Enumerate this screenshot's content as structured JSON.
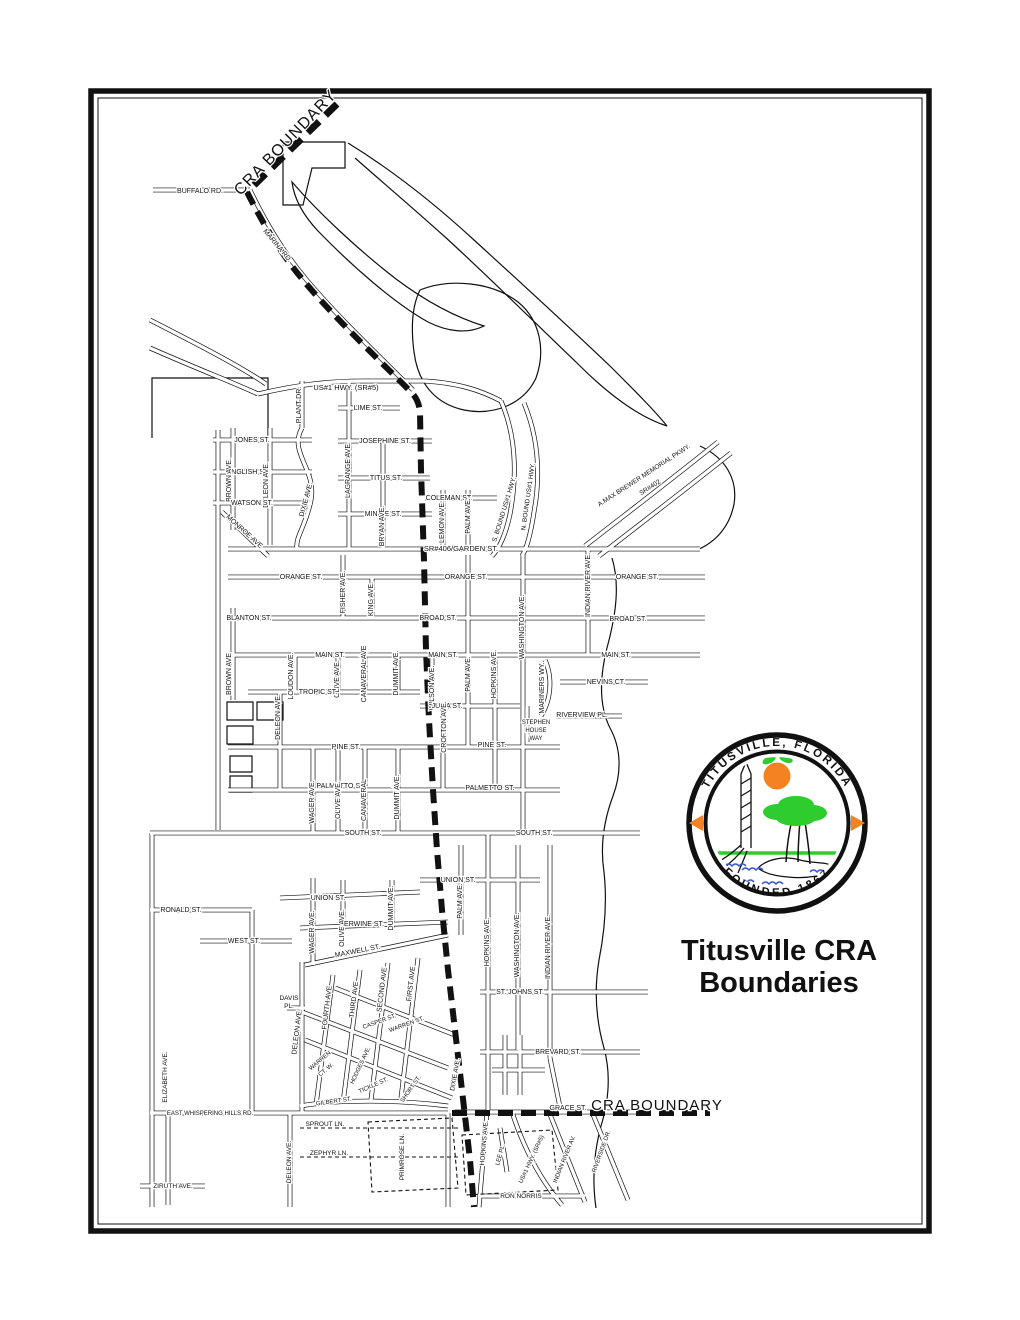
{
  "title": {
    "line1": "Titusville CRA",
    "line2": "Boundaries"
  },
  "seal": {
    "top_text": "TITUSVILLE, FLORIDA",
    "bottom_text": "FOUNDED  1867"
  },
  "colors": {
    "ink": "#111111",
    "seal_orange": "#F58220",
    "seal_green": "#2FCC2F",
    "seal_blue": "#3B5BCF"
  },
  "boundary": {
    "label_top": "CRA BOUNDARY",
    "label_bottom": "CRA BOUNDARY"
  },
  "map": {
    "labels": [
      {
        "t": "CRA BOUNDARY",
        "x": 289,
        "y": 146,
        "r": -46,
        "s": 16,
        "ls": 1
      },
      {
        "t": "BUFFALO RD.",
        "x": 200,
        "y": 193
      },
      {
        "t": "MARINA RD.",
        "x": 276,
        "y": 247,
        "r": 50
      },
      {
        "t": "US#1 HWY. (SR#5)",
        "x": 346,
        "y": 390,
        "s": 7.5
      },
      {
        "t": "PLANT DR.",
        "x": 301,
        "y": 405,
        "r": -90
      },
      {
        "t": "LIME ST.",
        "x": 368,
        "y": 410
      },
      {
        "t": "JONES ST.",
        "x": 252,
        "y": 442
      },
      {
        "t": "JOSEPHINE ST.",
        "x": 385,
        "y": 443
      },
      {
        "t": "ENGLISH ST.",
        "x": 248,
        "y": 474
      },
      {
        "t": "TITUS ST.",
        "x": 386,
        "y": 480
      },
      {
        "t": "BROWN AVE.",
        "x": 231,
        "y": 480,
        "r": -90
      },
      {
        "t": "DELEON AVE.",
        "x": 268,
        "y": 485,
        "r": -90
      },
      {
        "t": "DIXIE AVE.",
        "x": 308,
        "y": 500,
        "r": -75
      },
      {
        "t": "LAGRANGE AVE.",
        "x": 350,
        "y": 470,
        "r": -90
      },
      {
        "t": "WATSON ST.",
        "x": 252,
        "y": 505
      },
      {
        "t": "COLEMAN ST.",
        "x": 449,
        "y": 500
      },
      {
        "t": "MINNIE ST.",
        "x": 383,
        "y": 516
      },
      {
        "t": "BRYAN AVE.",
        "x": 384,
        "y": 526,
        "r": -90
      },
      {
        "t": "MONROE AVE",
        "x": 243,
        "y": 533,
        "r": 42
      },
      {
        "t": "LEMON AVE.",
        "x": 444,
        "y": 522,
        "r": -90
      },
      {
        "t": "PALM AVE.",
        "x": 470,
        "y": 516,
        "r": -90
      },
      {
        "t": "S. BOUND US#1 HWY.",
        "x": 506,
        "y": 510,
        "r": -73,
        "s": 6.5
      },
      {
        "t": "N. BOUND US#1 HWY.",
        "x": 530,
        "y": 497,
        "r": -82,
        "s": 6.5
      },
      {
        "t": "A.MAX BREWER MEMORIAL PKWY.",
        "x": 645,
        "y": 477,
        "r": -33,
        "s": 6.5
      },
      {
        "t": "SR#402",
        "x": 651,
        "y": 489,
        "r": -33,
        "s": 6.5
      },
      {
        "t": "SR#406/GARDEN ST.",
        "x": 461,
        "y": 551,
        "s": 7.5
      },
      {
        "t": "ORANGE ST.",
        "x": 301,
        "y": 579
      },
      {
        "t": "ORANGE ST.",
        "x": 466,
        "y": 579
      },
      {
        "t": "ORANGE ST.",
        "x": 637,
        "y": 579
      },
      {
        "t": "FISHER AVE.",
        "x": 345,
        "y": 592,
        "r": -90
      },
      {
        "t": "KING AVE.",
        "x": 373,
        "y": 599,
        "r": -90
      },
      {
        "t": "INDIAN RIVER AVE.",
        "x": 590,
        "y": 585,
        "r": -90
      },
      {
        "t": "BLANTON ST.",
        "x": 249,
        "y": 620
      },
      {
        "t": "BROAD ST.",
        "x": 438,
        "y": 620
      },
      {
        "t": "BROAD ST.",
        "x": 628,
        "y": 621
      },
      {
        "t": "WASHINGTON AVE.",
        "x": 524,
        "y": 627,
        "r": -90
      },
      {
        "t": "MAIN ST.",
        "x": 330,
        "y": 657
      },
      {
        "t": "MAIN ST.",
        "x": 443,
        "y": 657
      },
      {
        "t": "MAIN ST.",
        "x": 616,
        "y": 657
      },
      {
        "t": "BROWN AVE",
        "x": 231,
        "y": 674,
        "r": -90
      },
      {
        "t": "LOUDON AVE.",
        "x": 293,
        "y": 676,
        "r": -90
      },
      {
        "t": "OLIVE AVE.",
        "x": 339,
        "y": 679,
        "r": -90
      },
      {
        "t": "CANAVERAL AVE",
        "x": 366,
        "y": 674,
        "r": -90
      },
      {
        "t": "DUMMIT AVE.",
        "x": 398,
        "y": 673,
        "r": -90
      },
      {
        "t": "WILSON AVE.",
        "x": 434,
        "y": 688,
        "r": -90
      },
      {
        "t": "PALM AVE.",
        "x": 470,
        "y": 674,
        "r": -90
      },
      {
        "t": "HOPKINS AVE.",
        "x": 496,
        "y": 674,
        "r": -90
      },
      {
        "t": "NEVINS CT.",
        "x": 606,
        "y": 684
      },
      {
        "t": "MARINERS WY.",
        "x": 544,
        "y": 688,
        "r": -90
      },
      {
        "t": "TROPIC ST.",
        "x": 318,
        "y": 694
      },
      {
        "t": "JULIA ST.",
        "x": 447,
        "y": 708
      },
      {
        "t": "RIVERVIEW PL.",
        "x": 582,
        "y": 717
      },
      {
        "t": "STEPHEN",
        "x": 536,
        "y": 724,
        "s": 6
      },
      {
        "t": "HOUSE",
        "x": 536,
        "y": 732,
        "s": 6
      },
      {
        "t": "WAY",
        "x": 536,
        "y": 740,
        "s": 6
      },
      {
        "t": "DELEON AVE.",
        "x": 280,
        "y": 717,
        "r": -90
      },
      {
        "t": "CROFTON AVE.",
        "x": 446,
        "y": 727,
        "r": -90
      },
      {
        "t": "PINE ST.",
        "x": 346,
        "y": 749
      },
      {
        "t": "PINE ST.",
        "x": 492,
        "y": 747
      },
      {
        "t": "PALMETTO ST.",
        "x": 341,
        "y": 788
      },
      {
        "t": "PALMETTO ST.",
        "x": 490,
        "y": 790
      },
      {
        "t": "WAGER AVE.",
        "x": 314,
        "y": 802,
        "r": -90
      },
      {
        "t": "OLIVE AVE.",
        "x": 340,
        "y": 800,
        "r": -90
      },
      {
        "t": "CANAVERAL",
        "x": 366,
        "y": 800,
        "r": -90
      },
      {
        "t": "DUMMIT AVE.",
        "x": 399,
        "y": 797,
        "r": -90
      },
      {
        "t": "SOUTH ST.",
        "x": 363,
        "y": 835
      },
      {
        "t": "SOUTH ST.",
        "x": 534,
        "y": 835
      },
      {
        "t": "UNION ST.",
        "x": 458,
        "y": 882
      },
      {
        "t": "UNION ST.",
        "x": 328,
        "y": 900
      },
      {
        "t": "PALM AVE.",
        "x": 462,
        "y": 901,
        "r": -90
      },
      {
        "t": "HOPKINS AVE.",
        "x": 489,
        "y": 942,
        "r": -90
      },
      {
        "t": "WASHINGTON AVE.",
        "x": 519,
        "y": 945,
        "r": -90
      },
      {
        "t": "INDIAN RIVER AVE.",
        "x": 550,
        "y": 947,
        "r": -90
      },
      {
        "t": "WAGER AVE.",
        "x": 314,
        "y": 932,
        "r": -90
      },
      {
        "t": "OLIVE AVE.",
        "x": 344,
        "y": 928,
        "r": -90
      },
      {
        "t": "DUMMIT AVE.",
        "x": 393,
        "y": 908,
        "r": -90
      },
      {
        "t": "ERWINE ST.",
        "x": 364,
        "y": 926
      },
      {
        "t": "RONALD ST.",
        "x": 181,
        "y": 912
      },
      {
        "t": "WEST ST.",
        "x": 244,
        "y": 943
      },
      {
        "t": "MAXWELL ST.",
        "x": 358,
        "y": 953,
        "r": -11
      },
      {
        "t": "DAVIS",
        "x": 289,
        "y": 1000,
        "s": 6.5
      },
      {
        "t": "PL.",
        "x": 289,
        "y": 1008,
        "s": 6.5
      },
      {
        "t": "DELEON AVE.",
        "x": 299,
        "y": 1032,
        "r": -83
      },
      {
        "t": "FOURTH AVE",
        "x": 329,
        "y": 1008,
        "r": -83
      },
      {
        "t": "THIRD AVE",
        "x": 356,
        "y": 1000,
        "r": -83
      },
      {
        "t": "SECOND AVE",
        "x": 384,
        "y": 990,
        "r": -83
      },
      {
        "t": "FIRST AVE",
        "x": 413,
        "y": 984,
        "r": -83
      },
      {
        "t": "CASPER ST.",
        "x": 380,
        "y": 1023,
        "r": -20,
        "s": 6
      },
      {
        "t": "WARREN ST.",
        "x": 407,
        "y": 1026,
        "r": -20,
        "s": 6
      },
      {
        "t": "ST. JOHNS ST.",
        "x": 520,
        "y": 994
      },
      {
        "t": "WARREN",
        "x": 321,
        "y": 1062,
        "r": -40,
        "s": 6
      },
      {
        "t": "CT. W.",
        "x": 327,
        "y": 1071,
        "r": -40,
        "s": 6
      },
      {
        "t": "HODGES AVE.",
        "x": 362,
        "y": 1066,
        "r": -65,
        "s": 6
      },
      {
        "t": "TICKLE ST.",
        "x": 374,
        "y": 1087,
        "r": -24,
        "s": 6
      },
      {
        "t": "SHORT ST.",
        "x": 412,
        "y": 1090,
        "r": -55,
        "s": 6
      },
      {
        "t": "GILBERT ST.",
        "x": 334,
        "y": 1103,
        "r": -8,
        "s": 6
      },
      {
        "t": "DIXIE AVE.",
        "x": 457,
        "y": 1075,
        "r": -80,
        "s": 6.5
      },
      {
        "t": "BREVARD ST.",
        "x": 558,
        "y": 1054
      },
      {
        "t": "GRACE ST.",
        "x": 568,
        "y": 1110
      },
      {
        "t": "CRA BOUNDARY",
        "x": 657,
        "y": 1110,
        "s": 15,
        "ls": 1
      },
      {
        "t": "EAST WHISPERING HILLS RD.",
        "x": 210,
        "y": 1115,
        "s": 6
      },
      {
        "t": "SPROUT LN.",
        "x": 325,
        "y": 1126,
        "s": 6.5
      },
      {
        "t": "ZEPHYR LN.",
        "x": 329,
        "y": 1155,
        "s": 6.5
      },
      {
        "t": "ELIZABETH AVE.",
        "x": 167,
        "y": 1077,
        "r": -90,
        "s": 6.5
      },
      {
        "t": "DELEON AVE.",
        "x": 291,
        "y": 1162,
        "r": -90,
        "s": 6.5
      },
      {
        "t": "PRIMROSE LN.",
        "x": 404,
        "y": 1157,
        "r": -90,
        "s": 6.5
      },
      {
        "t": "ZIRUTH AVE.",
        "x": 173,
        "y": 1188,
        "s": 6.5
      },
      {
        "t": "HOPKINS AVE.",
        "x": 486,
        "y": 1143,
        "r": -85,
        "s": 6.5
      },
      {
        "t": "LEE PL.",
        "x": 502,
        "y": 1155,
        "r": -75,
        "s": 6
      },
      {
        "t": "US#1 HWY. (SR#5)",
        "x": 533,
        "y": 1160,
        "r": -65,
        "s": 6
      },
      {
        "t": "INDIAN RIVER AV.",
        "x": 566,
        "y": 1160,
        "r": -68,
        "s": 6
      },
      {
        "t": "RIVERSIDE DR.",
        "x": 603,
        "y": 1152,
        "r": -70,
        "s": 6
      },
      {
        "t": "RON NORRIS",
        "x": 521,
        "y": 1198,
        "s": 6.5
      }
    ]
  }
}
